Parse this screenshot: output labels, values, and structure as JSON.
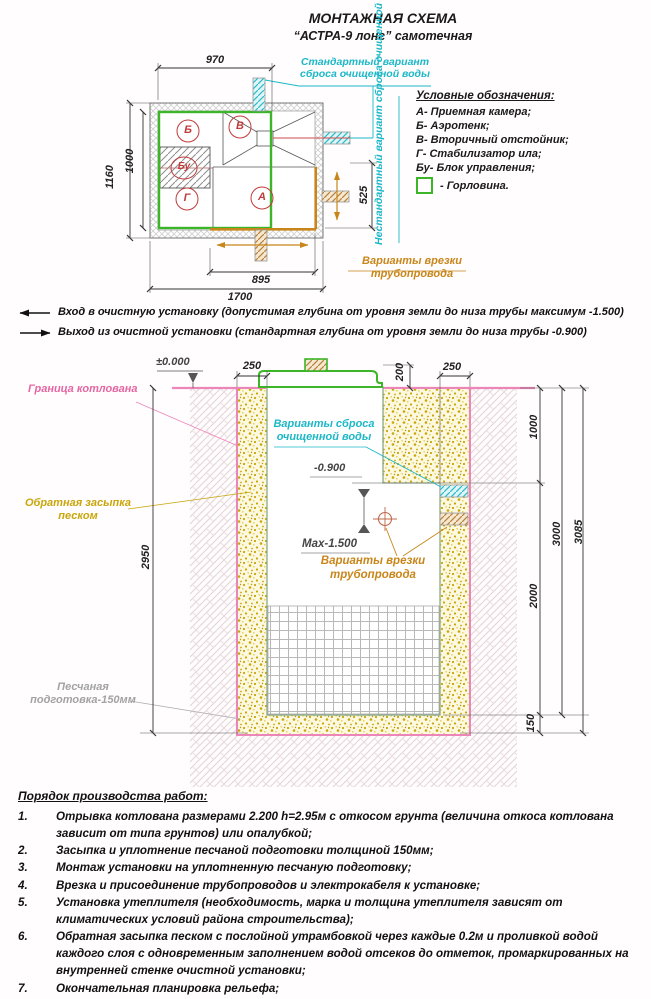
{
  "title": {
    "line1": "МОНТАЖНАЯ СХЕМА",
    "line2": "“АСТРА-9 лонг” самотечная"
  },
  "plan": {
    "dim_top": "970",
    "dim_left_outer": "1160",
    "dim_left_inner": "1000",
    "dim_right": "525",
    "dim_bottom_inner": "895",
    "dim_bottom_outer": "1700",
    "compartments": {
      "a": "А",
      "b": "Б",
      "v": "В",
      "g": "Г",
      "bu": "Бу"
    },
    "standard_discharge": "Стандартный вариант\nсброса очищенной воды",
    "nonstandard_discharge": "Нестандартный вариант\nсброса очищенной воды",
    "pipe_insertion": "Варианты врезки\nтрубопровода"
  },
  "legend": {
    "title": "Условные обозначения:",
    "items": [
      "А- Приемная камера;",
      "Б- Аэротенк;",
      "В- Вторичный отстойник;",
      "Г- Стабилизатор ила;",
      "Бу- Блок управления;"
    ],
    "neck": "- Горловина."
  },
  "io_notes": {
    "inlet": "Вход в очистную установку (допустимая глубина от уровня земли до низа трубы максимум -1.500)",
    "outlet": "Выход из очистной установки (стандартная глубина от уровня земли до низа трубы -0.900)"
  },
  "section": {
    "level_zero": "±0.000",
    "level_discharge": "-0.900",
    "level_max": "Max-1.500",
    "pit_boundary": "Граница котлована",
    "backfill": "Обратная засыпка\nпеском",
    "sand_prep": "Песчаная\nподготовка-150мм",
    "discharge_options": "Варианты сброса\nочищенной воды",
    "pipe_insertion": "Варианты врезки\nтрубопровода",
    "dim_left_sand": "250",
    "dim_lid_height": "200",
    "dim_right_sand": "250",
    "dim_depth_900": "1000",
    "dim_body": "2000",
    "dim_tank": "3000",
    "dim_total": "3085",
    "dim_sand_layer": "150",
    "dim_pit_depth": "2950"
  },
  "procedure": {
    "title": "Порядок производства работ:",
    "items": [
      {
        "n": "1.",
        "t": "Отрывка котлована размерами 2.200 h=2.95м с откосом грунта (величина откоса котлована зависит от типа грунтов) или опалубкой;"
      },
      {
        "n": "2.",
        "t": "Засыпка и уплотнение песчаной подготовки толщиной 150мм;"
      },
      {
        "n": "3.",
        "t": "Монтаж установки на уплотненную песчаную подготовку;"
      },
      {
        "n": "4.",
        "t": "Врезка и присоединение трубопроводов и электрокабеля к установке;"
      },
      {
        "n": "5.",
        "t": "Установка утеплителя (необходимость, марка и толщина утеплителя зависят от климатических условий района строительства);"
      },
      {
        "n": "6.",
        "t": "Обратная засыпка песком с послойной утрамбовкой через каждые 0.2м и проливкой водой каждого слоя с одновременным заполнением водой отсеков до отметок, промаркированных на внутренней стенке очистной установки;"
      },
      {
        "n": "7.",
        "t": "Окончательная планировка рельефа;"
      },
      {
        "n": "8.",
        "t": "Запуск очистной установки в эксплуатацию."
      }
    ]
  },
  "colors": {
    "green": "#3db529",
    "cyan": "#1cb8c8",
    "orange": "#c8861a",
    "pink": "#e566a3",
    "red": "#c23b3b",
    "sand": "#c9a60b",
    "gray": "#a3a3a3"
  }
}
